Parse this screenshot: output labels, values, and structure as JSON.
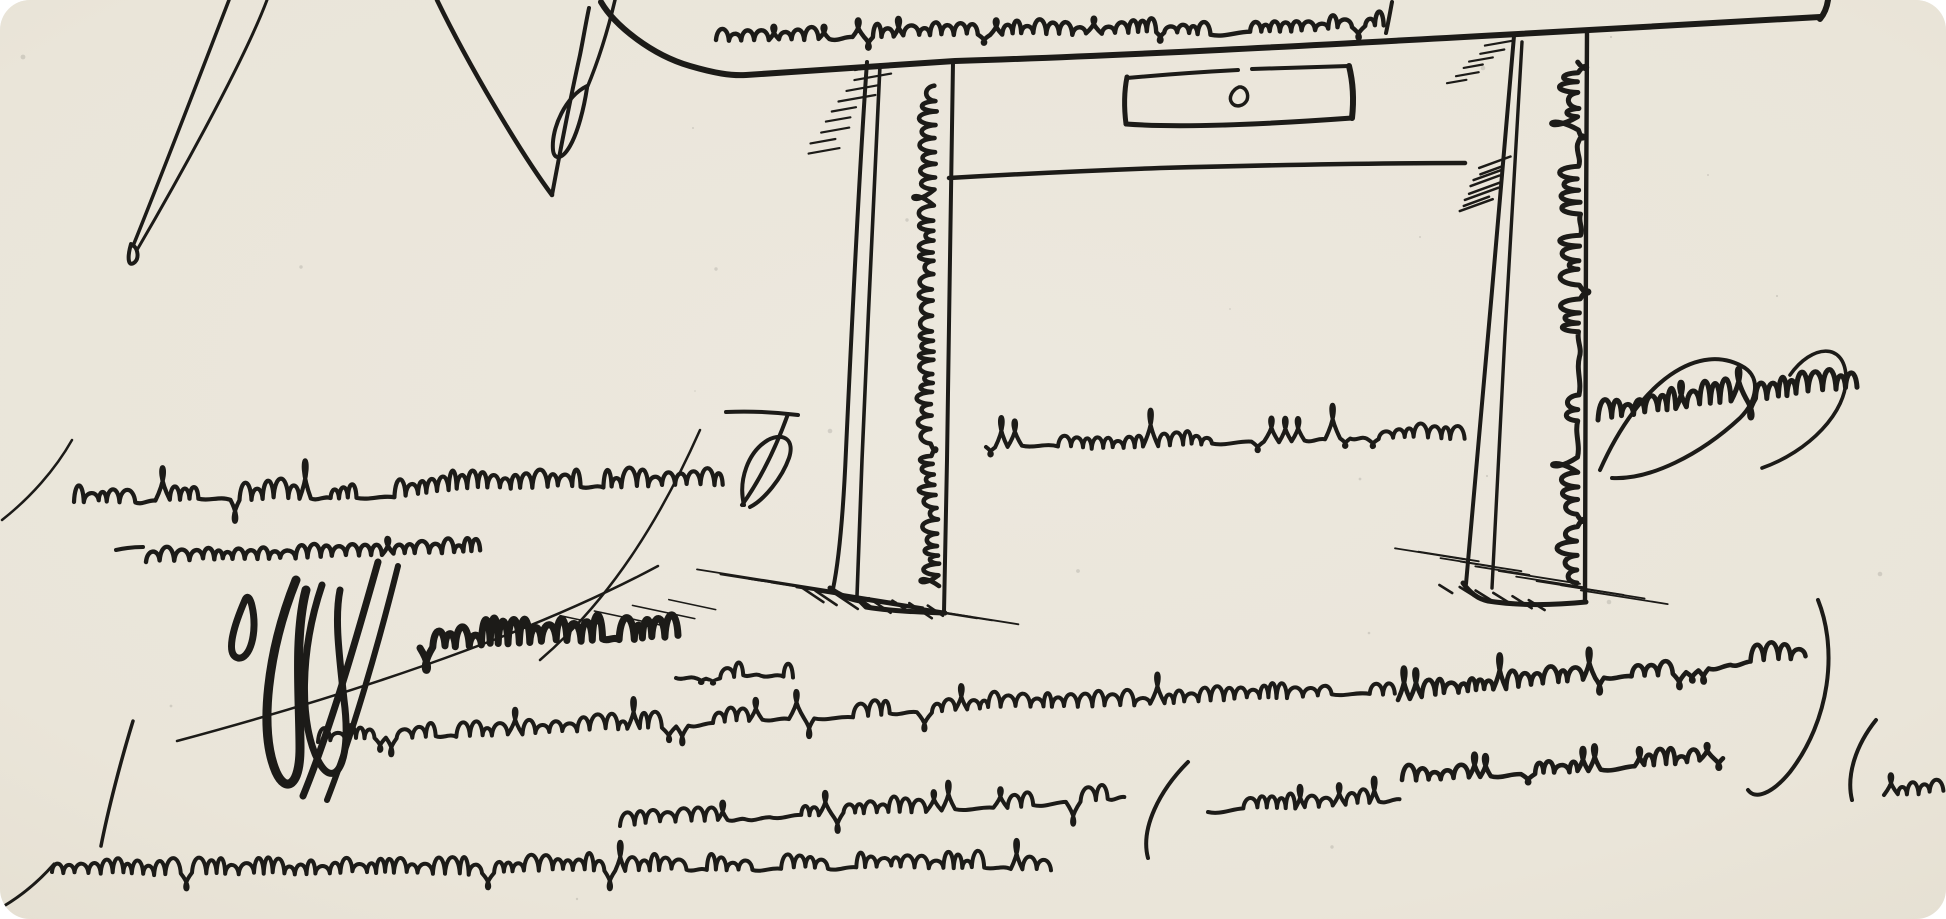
{
  "artwork": {
    "alt": "Pen-and-ink line drawing of a simple wooden side table with one drawer and a small knob; illegible flourished mock-cursive handwriting runs along the tabletop edge, down both table legs, and fills the paper around and beneath the table in many scrawled lines; hatched shadows sit at the feet of the legs; part of a large pen-nib-like line figure appears at the upper left.",
    "legible_text": "",
    "paper_color": "#eae5d9",
    "paper_color_center": "#ece8de",
    "ink_color": "#1c1b18",
    "scribble_bands": [
      {
        "name": "tabletop-script",
        "x": 716,
        "y": 40,
        "len": 660,
        "xh": 15,
        "asc": 24,
        "desc": 13,
        "w": 4.4,
        "slope": -20,
        "seed": 11
      },
      {
        "name": "left-leg-script",
        "x": 939,
        "y": 586,
        "len": 492,
        "xh": 19,
        "asc": 30,
        "desc": 9,
        "w": 4.6,
        "slope": 0,
        "rot": -90,
        "seed": 22
      },
      {
        "name": "right-leg-script",
        "x": 1577,
        "y": 583,
        "len": 512,
        "xh": 21,
        "asc": 32,
        "desc": 9,
        "w": 5,
        "slope": 0,
        "rot": -90,
        "seed": 33
      },
      {
        "name": "mid-row-script",
        "x": 986,
        "y": 447,
        "len": 470,
        "xh": 15,
        "asc": 42,
        "desc": 15,
        "w": 4,
        "slope": -8,
        "seed": 44
      },
      {
        "name": "right-mid-script",
        "x": 1598,
        "y": 420,
        "len": 252,
        "xh": 24,
        "asc": 46,
        "desc": 20,
        "w": 5,
        "slope": -28,
        "seed": 55
      },
      {
        "name": "row-a-script",
        "x": 74,
        "y": 502,
        "len": 648,
        "xh": 20,
        "asc": 56,
        "desc": 28,
        "w": 4.2,
        "slope": -14,
        "seed": 66
      },
      {
        "name": "row-b-script",
        "x": 146,
        "y": 562,
        "len": 330,
        "xh": 15,
        "asc": 24,
        "desc": 15,
        "w": 4.4,
        "slope": -12,
        "seed": 77
      },
      {
        "name": "row-c-bold-script",
        "x": 420,
        "y": 648,
        "len": 250,
        "xh": 26,
        "asc": 46,
        "desc": 32,
        "w": 7,
        "slope": -10,
        "seed": 88
      },
      {
        "name": "row-c-tail-script",
        "x": 676,
        "y": 678,
        "len": 115,
        "xh": 15,
        "asc": 22,
        "desc": 8,
        "w": 4,
        "slope": -6,
        "seed": 89
      },
      {
        "name": "row-d-script",
        "x": 318,
        "y": 742,
        "len": 1072,
        "xh": 17,
        "asc": 36,
        "desc": 20,
        "w": 4,
        "slope": -30,
        "seed": 99
      },
      {
        "name": "row-e-script",
        "x": 620,
        "y": 826,
        "len": 498,
        "xh": 16,
        "asc": 32,
        "desc": 24,
        "w": 4,
        "slope": -22,
        "seed": 110
      },
      {
        "name": "row-e2-script",
        "x": 1208,
        "y": 812,
        "len": 180,
        "xh": 16,
        "asc": 30,
        "desc": 18,
        "w": 4,
        "slope": -10,
        "seed": 111
      },
      {
        "name": "row-r1-script",
        "x": 1398,
        "y": 700,
        "len": 400,
        "xh": 19,
        "asc": 40,
        "desc": 16,
        "w": 4.6,
        "slope": -40,
        "seed": 122
      },
      {
        "name": "row-r2-script",
        "x": 1402,
        "y": 780,
        "len": 320,
        "xh": 17,
        "asc": 30,
        "desc": 13,
        "w": 4.6,
        "slope": -18,
        "seed": 133
      },
      {
        "name": "row-r2b-script",
        "x": 1884,
        "y": 795,
        "len": 58,
        "xh": 15,
        "asc": 26,
        "desc": 11,
        "w": 4,
        "slope": -6,
        "seed": 134
      },
      {
        "name": "bottom-row-script",
        "x": 52,
        "y": 872,
        "len": 988,
        "xh": 17,
        "asc": 40,
        "desc": 24,
        "w": 4,
        "slope": -12,
        "seed": 144
      }
    ],
    "hatch_sets": [
      {
        "name": "left-leg-top-hatch",
        "x": 858,
        "y": 70,
        "sx": -1.6,
        "sy": 10.5,
        "n": 9,
        "len": 30,
        "ang": -10,
        "w": 2.2,
        "seed": 1
      },
      {
        "name": "right-leg-top-hatch",
        "x": 1486,
        "y": 46,
        "sx": -2,
        "sy": 7.5,
        "n": 6,
        "len": 24,
        "ang": -10,
        "w": 2.2,
        "seed": 2
      },
      {
        "name": "right-leg-block-hatch",
        "x": 1482,
        "y": 168,
        "sx": -0.8,
        "sy": 6.3,
        "n": 8,
        "len": 30,
        "ang": -20,
        "w": 2.5,
        "seed": 3
      },
      {
        "name": "left-foot-shadow-hatch",
        "x": 698,
        "y": 570,
        "sx": 6,
        "sy": 4.3,
        "n": 10,
        "len": 115,
        "ang": 9,
        "w": 1.8,
        "seed": 4
      },
      {
        "name": "left-foot-dark-hatch",
        "x": 800,
        "y": 588,
        "sx": 4.5,
        "sy": 2.6,
        "n": 8,
        "len": 24,
        "ang": 34,
        "w": 2.6,
        "seed": 5
      },
      {
        "name": "right-foot-shadow-hatch",
        "x": 1398,
        "y": 548,
        "sx": 5,
        "sy": 4.6,
        "n": 10,
        "len": 72,
        "ang": 9,
        "w": 1.8,
        "seed": 6
      },
      {
        "name": "right-foot-dark-hatch",
        "x": 1442,
        "y": 584,
        "sx": 4.4,
        "sy": 3.2,
        "n": 6,
        "len": 20,
        "ang": 32,
        "w": 2.6,
        "seed": 7
      },
      {
        "name": "left-foot-below-hatch",
        "x": 668,
        "y": 600,
        "sx": -9,
        "sy": 5.5,
        "n": 4,
        "len": 58,
        "ang": 12,
        "w": 1.6,
        "seed": 8
      }
    ],
    "speckles": {
      "count": 22,
      "seed": 7,
      "opacity": 0.12
    }
  }
}
